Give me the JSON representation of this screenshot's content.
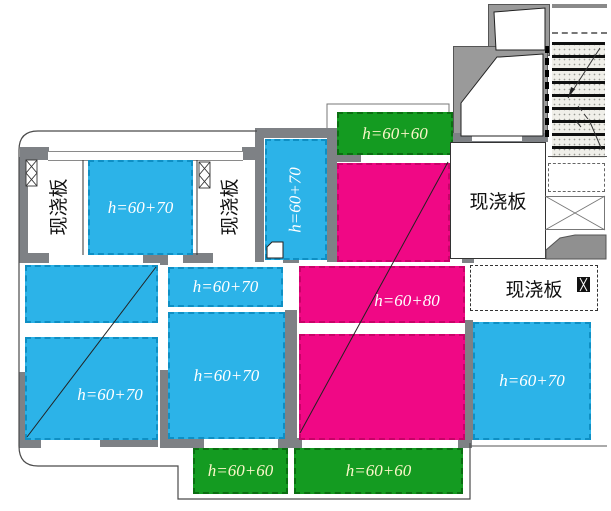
{
  "plan": {
    "slabs": [
      {
        "id": "blue-top-left",
        "type": "blue",
        "label": "h=60+70",
        "orientation": "horizontal"
      },
      {
        "id": "blue-vertical",
        "type": "blue",
        "label": "h=60+70",
        "orientation": "vertical"
      },
      {
        "id": "green-top",
        "type": "green",
        "label": "h=60+60",
        "orientation": "horizontal"
      },
      {
        "id": "pink-large",
        "type": "pink",
        "label": "h=60+80",
        "orientation": "horizontal"
      },
      {
        "id": "blue-upper-center",
        "type": "blue",
        "label": "h=60+70",
        "orientation": "horizontal"
      },
      {
        "id": "blue-center",
        "type": "blue",
        "label": "h=60+70",
        "orientation": "horizontal"
      },
      {
        "id": "blue-left-large",
        "type": "blue",
        "label": "h=60+70",
        "orientation": "horizontal"
      },
      {
        "id": "blue-right",
        "type": "blue",
        "label": "h=60+70",
        "orientation": "horizontal"
      },
      {
        "id": "green-bottom-left",
        "type": "green",
        "label": "h=60+60",
        "orientation": "horizontal"
      },
      {
        "id": "green-bottom-center",
        "type": "green",
        "label": "h=60+60",
        "orientation": "horizontal"
      }
    ],
    "rooms": [
      {
        "id": "cast-left",
        "label": "现浇板",
        "orientation": "vertical"
      },
      {
        "id": "cast-mid",
        "label": "现浇板",
        "orientation": "vertical"
      },
      {
        "id": "cast-right",
        "label": "现浇板",
        "orientation": "horizontal"
      },
      {
        "id": "cast-bottom",
        "label": "现浇板",
        "orientation": "horizontal"
      }
    ],
    "colors": {
      "slab_blue": "#2CB3E8",
      "slab_pink": "#F00885",
      "slab_green": "#149B21",
      "wall_gray": "#7E8185",
      "blue_pink_label_text": "#FFFFFF",
      "green_label_text": "#FAF6C8",
      "room_label_text": "#111111"
    }
  }
}
